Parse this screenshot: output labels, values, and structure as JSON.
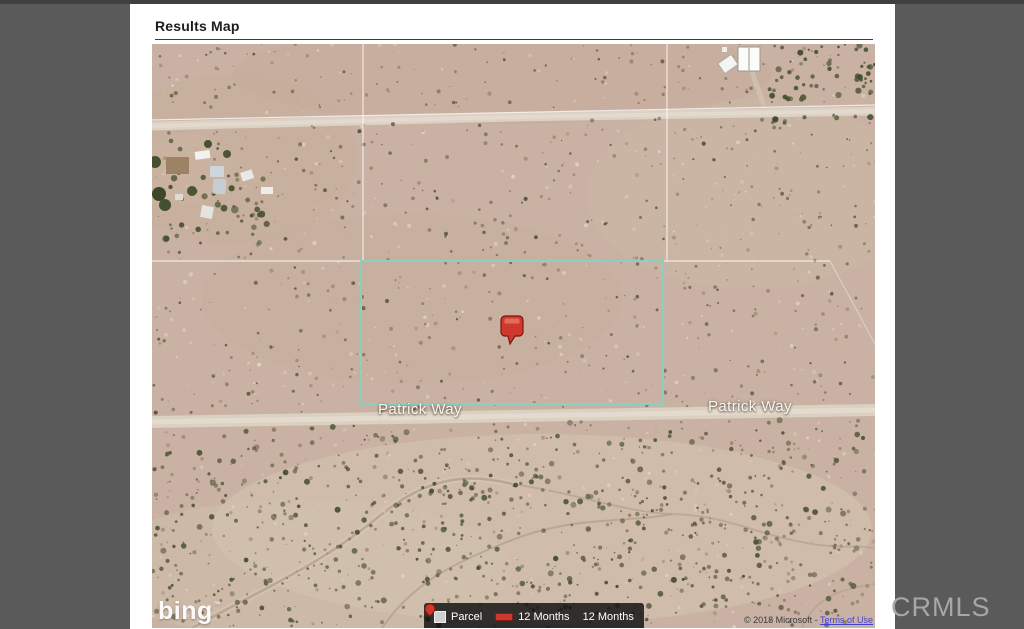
{
  "page": {
    "title": "Results Map"
  },
  "map": {
    "street_labels": [
      "Patrick Way",
      "Patrick Way"
    ],
    "provider_logo": "bing",
    "provider_tm": "™",
    "copyright": "© 2018 Microsoft -",
    "copyright_link": "Terms of Use"
  },
  "legend": {
    "items": [
      {
        "icon": "parcel-swatch-icon",
        "label": "Parcel"
      },
      {
        "icon": "sold-line-icon",
        "label": "12 Months"
      },
      {
        "icon": "sold-pin-icon",
        "label": "12 Months"
      }
    ]
  },
  "watermark": "CRMLS",
  "colors": {
    "app_background": "#5a5a5a",
    "map_base": "#c9b2a3",
    "parcel_outline": "#8ad0c2",
    "marker": "#cf392d",
    "legend_background": "rgba(15,15,15,0.82)"
  }
}
